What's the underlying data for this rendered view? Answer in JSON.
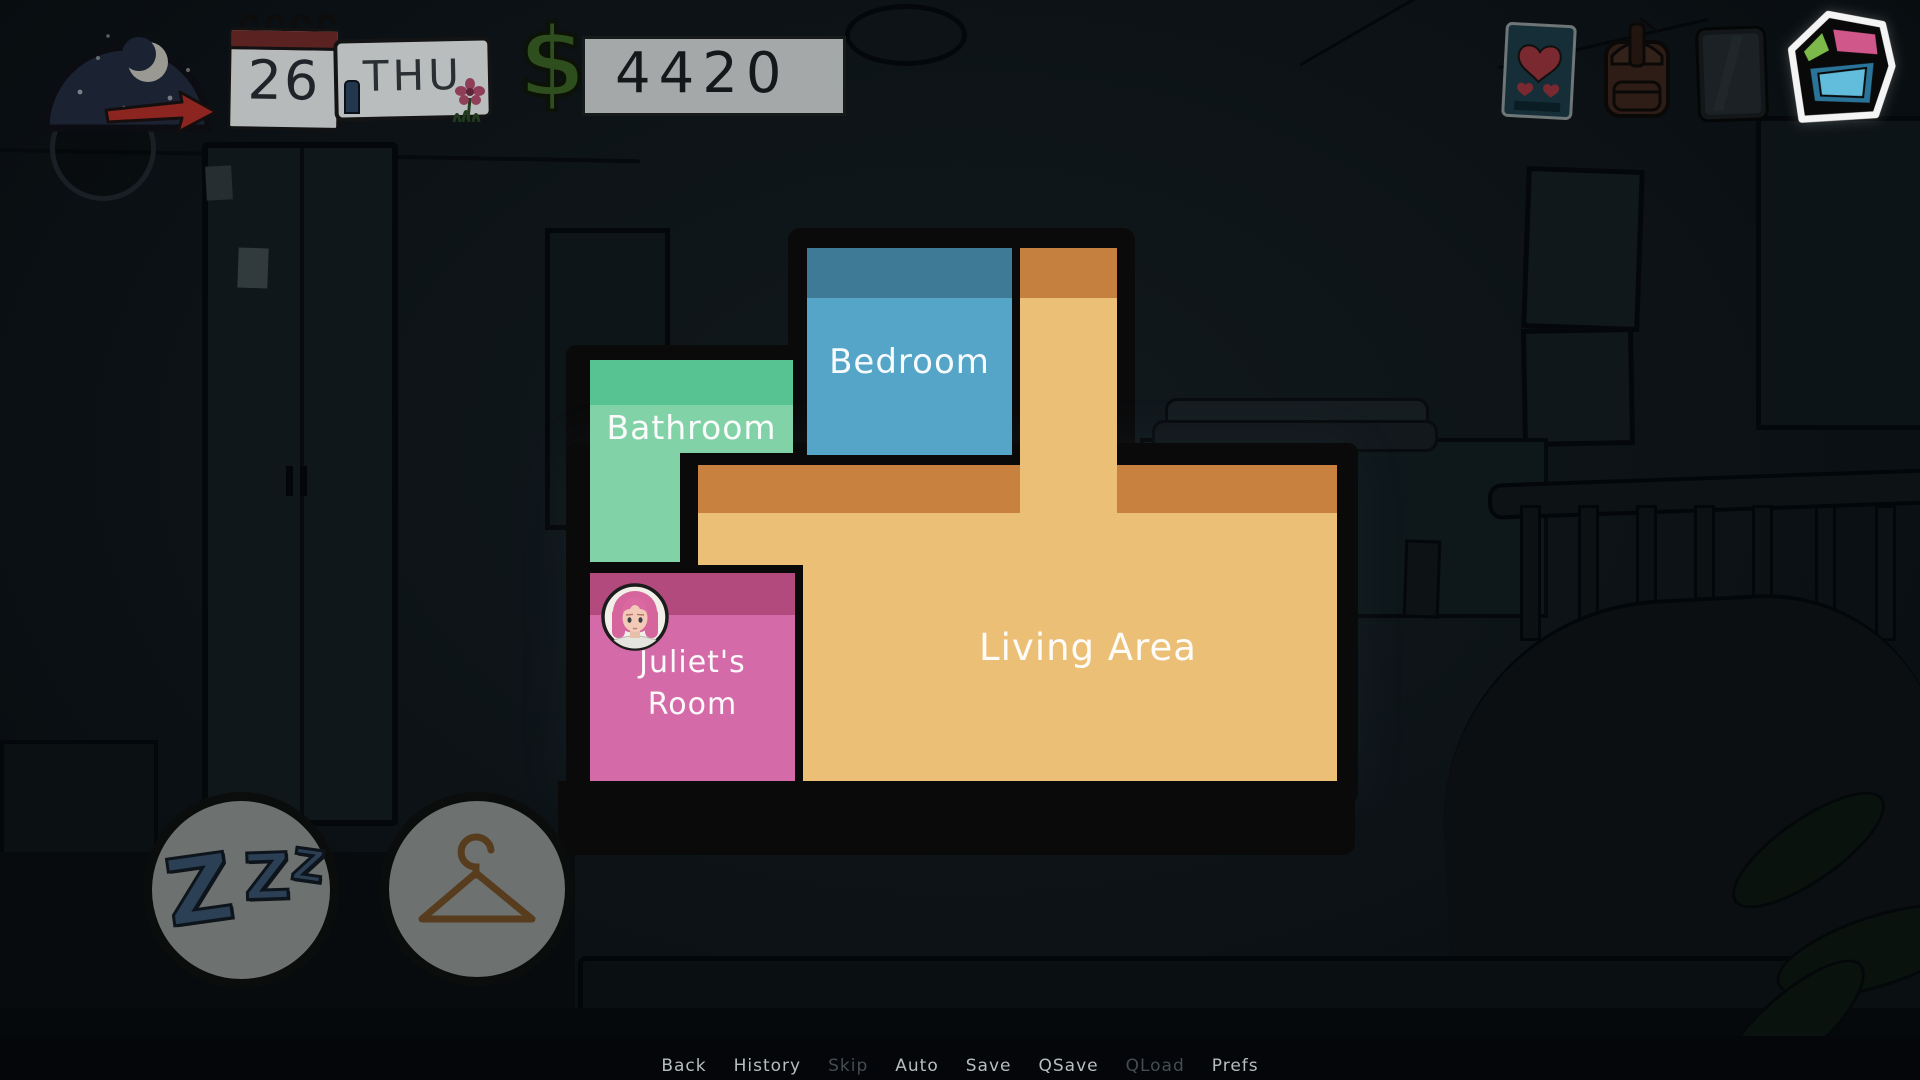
{
  "hud": {
    "time": {
      "icon": "moon",
      "period": "night"
    },
    "calendar": {
      "day": "26",
      "weekday": "THU"
    },
    "money": {
      "symbol": "$",
      "amount": "4420"
    },
    "inventory": {
      "items": [
        {
          "id": "love-letter",
          "icon": "heart-card"
        },
        {
          "id": "backpack",
          "icon": "backpack"
        },
        {
          "id": "phone",
          "icon": "phone"
        },
        {
          "id": "map",
          "icon": "floorplan-cube",
          "active": true
        }
      ]
    }
  },
  "floorplan": {
    "rooms": [
      {
        "id": "bedroom",
        "label": "Bedroom",
        "color": "#55a5c9",
        "band_color": "#3e7a96"
      },
      {
        "id": "bathroom",
        "label": "Bathroom",
        "color": "#81d2a6",
        "band_color": "#58c392"
      },
      {
        "id": "juliets-room",
        "label": "Juliet's Room",
        "color": "#d56aa9",
        "band_color": "#b24a7e",
        "occupant": "Juliet"
      },
      {
        "id": "living-area",
        "label": "Living Area",
        "color": "#ecbf77",
        "band_color": "#c9813f"
      }
    ]
  },
  "action_buttons": [
    {
      "id": "sleep",
      "icon": "zzz",
      "letters": [
        "Z",
        "Z",
        "Z"
      ]
    },
    {
      "id": "wardrobe",
      "icon": "hanger"
    }
  ],
  "quick_menu": {
    "items": [
      {
        "label": "Back",
        "enabled": true
      },
      {
        "label": "History",
        "enabled": true
      },
      {
        "label": "Skip",
        "enabled": false
      },
      {
        "label": "Auto",
        "enabled": true
      },
      {
        "label": "Save",
        "enabled": true
      },
      {
        "label": "QSave",
        "enabled": true
      },
      {
        "label": "QLoad",
        "enabled": false
      },
      {
        "label": "Prefs",
        "enabled": true
      }
    ]
  },
  "colors": {
    "money_green": "#2f4e1e",
    "active_icon_outline": "#f4f4f4",
    "map_icon_green": "#7cb94a",
    "map_icon_pink": "#cf5789",
    "map_icon_blue": "#62bcdc",
    "map_frame_black": "#0a0a0b"
  }
}
